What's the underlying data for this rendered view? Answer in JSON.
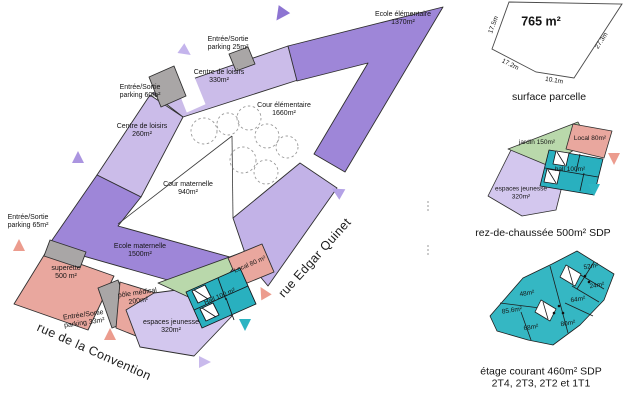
{
  "plan": {
    "streets": {
      "convention": "rue de la Convention",
      "edgar_quinet": "rue Edgar Quinet"
    },
    "labels": [
      {
        "id": "ecole-elementaire",
        "line1": "Ecole élémentaire",
        "line2": "1370m²"
      },
      {
        "id": "parking-25",
        "line1": "Entrée/Sortie",
        "line2": "parking 25m²"
      },
      {
        "id": "centre-loisirs-330",
        "line1": "Centre de loisirs",
        "line2": "330m²"
      },
      {
        "id": "parking-60",
        "line1": "Entrée/Sortie",
        "line2": "parking 60m²"
      },
      {
        "id": "centre-loisirs-260",
        "line1": "Centre de loisirs",
        "line2": "260m²"
      },
      {
        "id": "cour-elementaire",
        "line1": "Cour élémentaire",
        "line2": "1660m²"
      },
      {
        "id": "cour-maternelle",
        "line1": "Cour maternelle",
        "line2": "940m²"
      },
      {
        "id": "parking-65",
        "line1": "Entrée/Sortie",
        "line2": "parking 65m²"
      },
      {
        "id": "ecole-maternelle",
        "line1": "Ecole maternelle",
        "line2": "1500m²"
      },
      {
        "id": "superette",
        "line1": "superette",
        "line2": "500 m²"
      },
      {
        "id": "pole-medical",
        "line1": "pôle médical",
        "line2": "200m²"
      },
      {
        "id": "parking-33",
        "line1": "Entrée/Sortie",
        "line2": "parking 33m²"
      },
      {
        "id": "espaces-jeunesse",
        "line1": "espaces jeunesse",
        "line2": "320m²"
      },
      {
        "id": "local-80",
        "line1": "Local 80 m²"
      },
      {
        "id": "hall-100",
        "line1": "Hall 100 m²"
      }
    ]
  },
  "parcel": {
    "area": "765 m²",
    "caption": "surface parcelle",
    "dimensions": [
      "17.5m",
      "17.2m",
      "10.1m",
      "27.3m"
    ]
  },
  "ground_floor": {
    "caption": "rez-de-chaussée 500m² SDP",
    "rooms": {
      "jardin": "jardin 150m²",
      "local": "Local 80m²",
      "hall": "hall 100m²",
      "espaces_line1": "espaces jeunesse",
      "espaces_line2": "320m²"
    }
  },
  "upper_floor": {
    "caption_line1": "étage courant 460m² SDP",
    "caption_line2": "2T4, 2T3, 2T2 et 1T1",
    "rooms": [
      "52m²",
      "24m²",
      "48m²",
      "64m²",
      "85.6m²",
      "68m²",
      "80m²"
    ]
  },
  "colors": {
    "purple_medium": "#9e86d8",
    "purple_light": "#cbbce9",
    "lavender": "#d3c7ee",
    "salmon": "#e9a79e",
    "teal": "#29b0bf",
    "green": "#b9d8ab",
    "gray": "#a9a6a6"
  }
}
